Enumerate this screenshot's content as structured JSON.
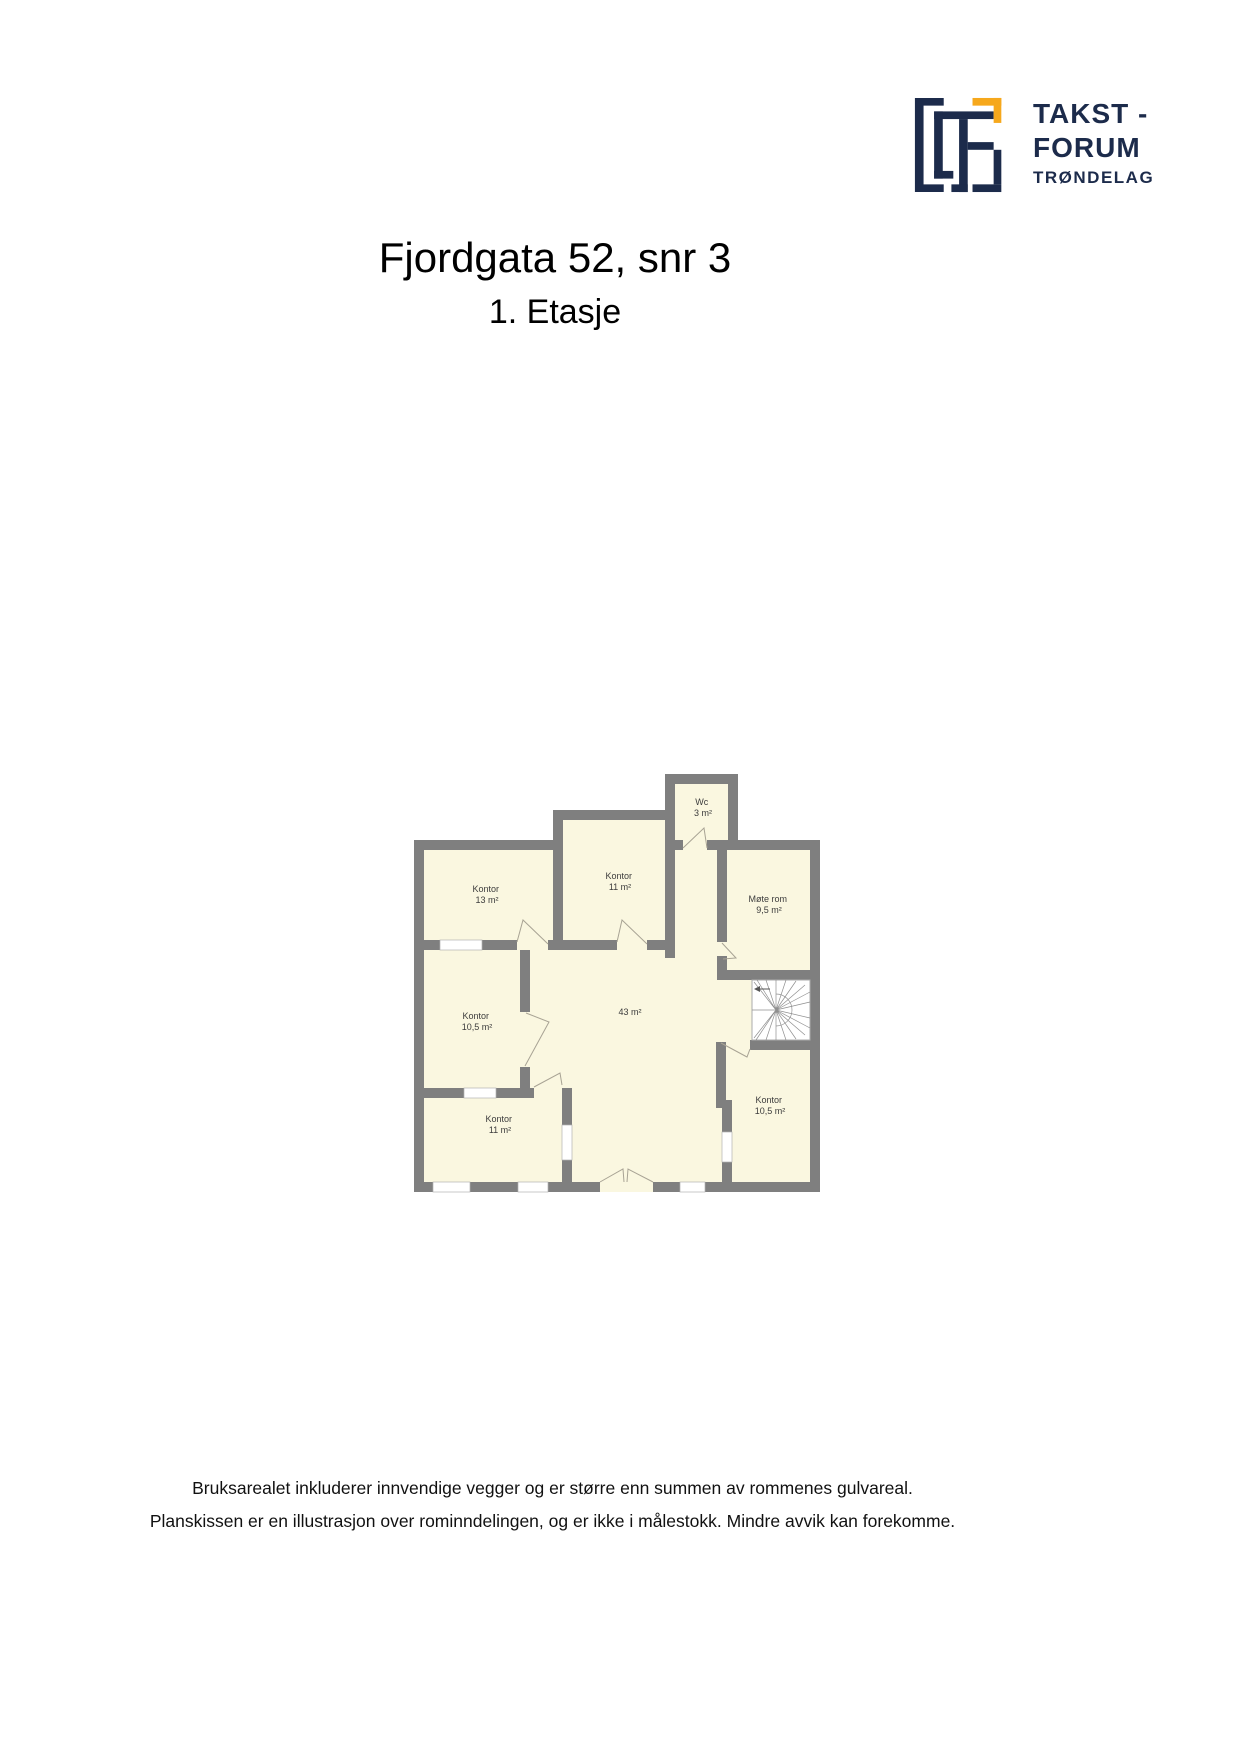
{
  "logo": {
    "line1": "TAKST -",
    "line2": "FORUM",
    "line3": "TRØNDELAG",
    "navy": "#1c2b4b",
    "yellow": "#f6a81c"
  },
  "header": {
    "title": "Fjordgata 52, snr 3",
    "subtitle": "1. Etasje"
  },
  "plan": {
    "colors": {
      "wall": "#7f7f7f",
      "room_fill": "#faf7e0",
      "window": "#ffffff",
      "stairs": "#ffffff"
    },
    "rooms": [
      {
        "name": "Kontor",
        "area": "13 m²"
      },
      {
        "name": "Kontor",
        "area": "11 m²"
      },
      {
        "name": "Wc",
        "area": "3 m²"
      },
      {
        "name": "Møte rom",
        "area": "9,5 m²"
      },
      {
        "name": "Kontor",
        "area": "10,5 m²"
      },
      {
        "name": "",
        "area": "43 m²"
      },
      {
        "name": "Kontor",
        "area": "11 m²"
      },
      {
        "name": "Kontor",
        "area": "10,5 m²"
      }
    ]
  },
  "footer": {
    "line1": "Bruksarealet inkluderer innvendige vegger og er større enn summen av rommenes gulvareal.",
    "line2": "Planskissen er en illustrasjon over rominndelingen, og er ikke i målestokk. Mindre avvik kan forekomme."
  }
}
